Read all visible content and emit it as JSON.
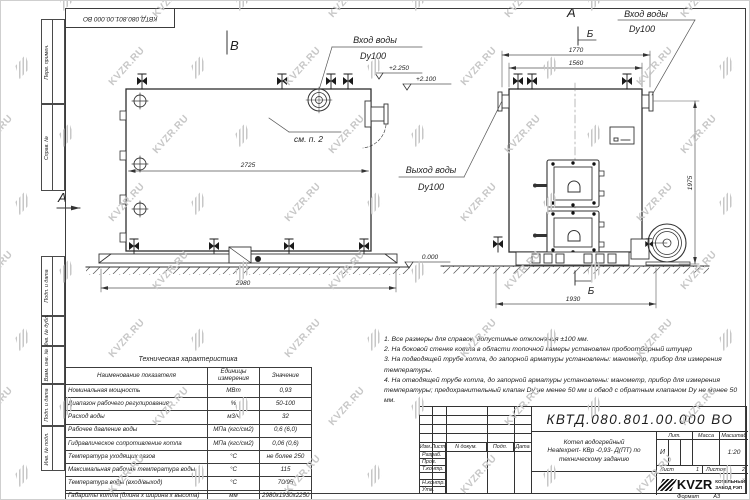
{
  "designation": "КВТД.080.801.00.000  ВО",
  "sheet": {
    "watermark": "KVZR.RU",
    "format_label": "Формат",
    "format_value": "А3"
  },
  "margin_labels": {
    "top1": "Перв. примен.",
    "top2": "Справ. №",
    "b1": "Подп. и дата",
    "b2": "Инв. № дубл.",
    "b3": "Взам. инв. №",
    "b4": "Подп. и дата",
    "b5": "Инв. № подл."
  },
  "views": {
    "label_a": "А",
    "label_b": "В",
    "label_sec": "Б",
    "inlet_line1": "Вход воды",
    "inlet_line2": "Dy100",
    "outlet_line1": "Выход воды",
    "outlet_line2": "Dy100",
    "see_note": "см. п. 2",
    "elev_top": "+2.250",
    "elev_mid": "+2.100",
    "elev_zero": "0.000",
    "dims": {
      "length_inner": "2725",
      "length_overall": "2980",
      "width_overall": "1770",
      "width_body": "1560",
      "width_base": "1930",
      "height": "1975"
    }
  },
  "notes": [
    "1. Все размеры для справок, допустимые отклонения ±100 мм.",
    "2. На боковой стенке котла в области топочной камеры установлен пробоотборный штуцер",
    "3. На подводящей трубе котла, до запорной арматуры установлены: манометр, прибор для измерения температуры.",
    "4. На отводящей трубе котла, до запорной арматуры установлены: манометр, прибор для измерения температуры; предохранительный клапан Dу не менее 50 мм и обвод с обратным клапаном Dу не менее 50 мм."
  ],
  "table": {
    "title": "Техническая характеристика",
    "headers": [
      "Наименование показателя",
      "Единицы измерения",
      "Значение"
    ],
    "rows": [
      [
        "Номинальная мощность",
        "МВт",
        "0,93"
      ],
      [
        "Диапазон рабочего регулирования",
        "%",
        "50-100"
      ],
      [
        "Расход воды",
        "м3/ч",
        "32"
      ],
      [
        "Рабочее давление воды",
        "МПа (кгс/см2)",
        "0,6 (6,0)"
      ],
      [
        "Гидравлическое сопротивление котла",
        "МПа (кгс/см2)",
        "0,06 (0,6)"
      ],
      [
        "Температура уходящих газов",
        "°С",
        "не более 250"
      ],
      [
        "Максимальная рабочая температура воды",
        "°С",
        "115"
      ],
      [
        "Температура воды (вход/выход)",
        "°С",
        "70/95"
      ],
      [
        "Габариты котла (длина х ширина х высота)",
        "мм",
        "2980х1930х2250"
      ]
    ]
  },
  "title_block": {
    "header_cols": [
      "Изм.",
      "Лист",
      "N докум.",
      "Подп.",
      "Дата"
    ],
    "rows": [
      "Разраб.",
      "Пров.",
      "Т.контр.",
      "Н.контр.",
      "Утв."
    ],
    "name_line1": "Котел водогрейный",
    "name_line2": "Heatexpert- КВр -0,93- Д(ПТ) по",
    "name_line3": "техническому заданию",
    "lit_label": "Лит.",
    "lit_value": "И",
    "mass_label": "Масса",
    "scale_label": "Масштаб",
    "scale_value": "1:20",
    "sheet_label": "Лист",
    "sheet_value": "1",
    "sheets_label": "Листов",
    "sheets_value": "2",
    "company_logo": "KVZR",
    "company_line1": "КОТЕЛЬНЫЙ",
    "company_line2": "ЗАВОД РЭП"
  }
}
